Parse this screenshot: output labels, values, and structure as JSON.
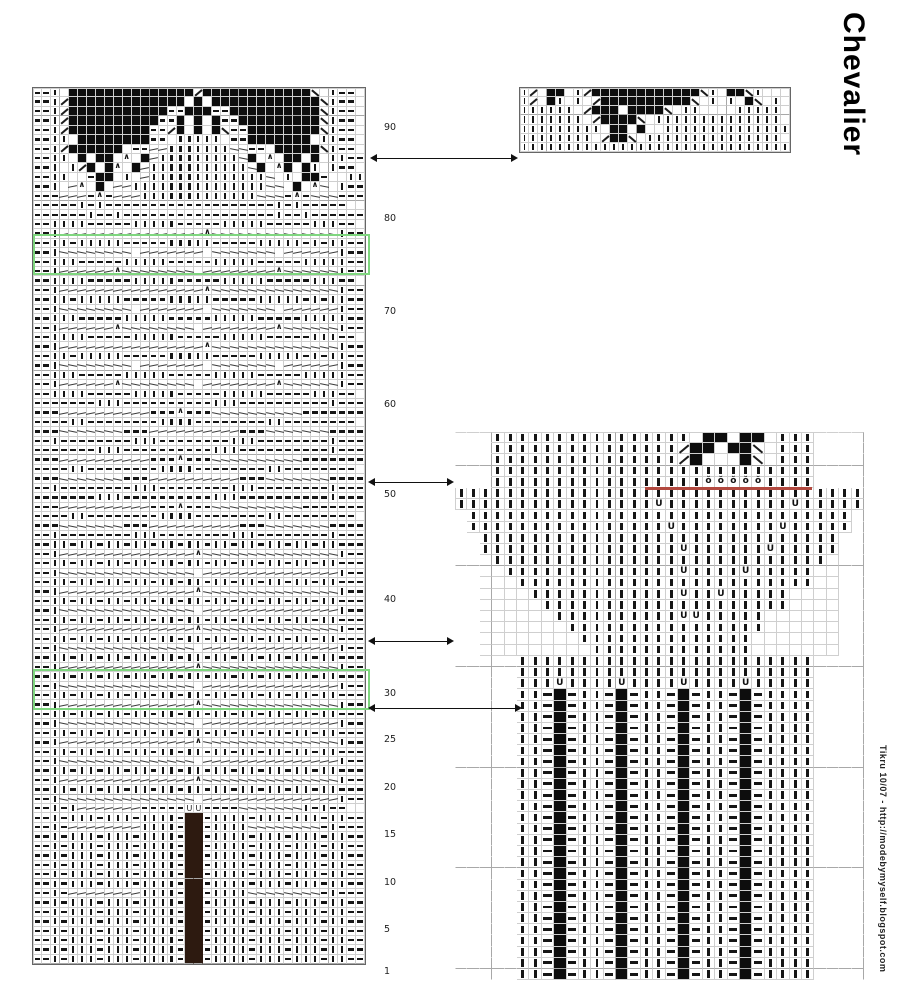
{
  "title": "Chevalier",
  "credit": "Tikru 10/07 - http://modebymyself.blogspot.com",
  "colors": {
    "background": "#ffffff",
    "symbol": "#151515",
    "grid": "#cfcfcf",
    "grid_heavy": "#a8a8a8",
    "repeat_box_green": "#7fd67f",
    "marker_line_red": "#b2493f",
    "dark_column_brown": "#2d1a10",
    "filled_square_black": "#0d0d0d"
  },
  "symbols": {
    "-": "purl-dash",
    "|": "knit-bar",
    "#": "filled-square",
    "B": "dark-column-stitch",
    "/": "right-leaning-decrease",
    "\\": "left-leaning-decrease",
    "^": "centered-double-decrease",
    "u": "u-stitch",
    "U": "bold-u-stitch",
    "o": "twisted-stitch",
    "z": "travel-line-up",
    "x": "travel-line-down",
    ".": "empty-cell",
    " ": "no-cell"
  },
  "row_numbers": {
    "x": 384,
    "labels": [
      {
        "n": "90",
        "y": 128
      },
      {
        "n": "80",
        "y": 219
      },
      {
        "n": "70",
        "y": 312
      },
      {
        "n": "60",
        "y": 405
      },
      {
        "n": "50",
        "y": 495
      },
      {
        "n": "40",
        "y": 600
      },
      {
        "n": "30",
        "y": 694
      },
      {
        "n": "25",
        "y": 740
      },
      {
        "n": "20",
        "y": 788
      },
      {
        "n": "15",
        "y": 835
      },
      {
        "n": "10",
        "y": 883
      },
      {
        "n": "5",
        "y": 930
      },
      {
        "n": "1",
        "y": 972
      }
    ]
  },
  "overlays": {
    "green_boxes": [
      {
        "x": 33,
        "y": 234,
        "w": 333,
        "h": 37
      },
      {
        "x": 33,
        "y": 669,
        "w": 333,
        "h": 37
      }
    ],
    "red_line": {
      "x": 645,
      "y": 487,
      "w": 167
    },
    "arrows": [
      {
        "x1": 372,
        "y": 158,
        "x2": 516
      },
      {
        "x1": 370,
        "y": 482,
        "x2": 452
      },
      {
        "x1": 370,
        "y": 641,
        "x2": 452
      },
      {
        "x1": 370,
        "y": 708,
        "x2": 520
      }
    ]
  },
  "charts": {
    "main": {
      "x": 33,
      "y": 88,
      "cols": 37,
      "cell_w": 8.97,
      "cell_h": 9.43,
      "pad": ".",
      "bordered": true,
      "rows": [
        "--|.##############/############\\.|--",
        "--|/#############.#.############\\|--",
        "--|/###########--###--##########\\|--",
        "--|/##########--#.#.#--#########\\|--",
        "--|/#########--/#.#.#\\--########\\|--",
        "--||.########--.|||||.--#######.||--",
        "--|/######.--zz|||||||xx--.#####\\|--",
        "--||.#.##.^.#z|||||||||x#.^.##.#.||--",
        "--|.|/#.#^.#z|||||||||||x#.^#.#|.|--",
        "--||..-##.|.z|||||||||||||x.|.##-..||",
        "--|.z^.#.zz|||||||||||||||xx.#.^x.|--",
        "---zzz-^-zzz|||||||||||||xxx-^-xxx---",
        "-----|-|-------------------|-|-----..",
        "------|--|-----------------|--|------",
        "--||||-----|||||-----|||||-----|||--",
        "--|zzzzzzzzzzzzzzzz^xxxxxxxxxxxxxx|--",
        "--||-|||||-----|||||-----|||||-|-||--",
        "--|xxxxxxxx.zzzzzzz.xxxxxxx.zzzzzz|--",
        "--|||-----|||||-----|||||-----|||||--",
        "--|zzzzzz^xxxxxxxx.zzzzzzzz^xxxxxx|--",
        "--||||-----|||||-----|||||-----|||--",
        "--|zzzzzzzzzzzzzzzz^xxxxxxxxxxxxxx|--",
        "--||-|||||-----|||||-----|||||-|-||--",
        "--|xxxxxxxx.zzzzzzz.xxxxxxx.zzzzzz|--",
        "--|||-----|||||-----|||||-----|||||--",
        "--|zzzzzz^xxxxxxxx.zzzzzzzz^xxxxxx|--",
        "--||||-----|||||-----|||||-----|||--",
        "--|zzzzzzzzzzzzzzzz^xxxxxxxxxxxxxx|--",
        "--||-|||||-----|||||-----|||||-|-||--",
        "--|xxxxxxxx.zzzzzzz.xxxxxxx.zzzzzz|--",
        "--|||-----|||||-----|||||-----|||||--",
        "--|zzzzzz^xxxxxxxx.zzzzzzzz^xxxxxx|--",
        "--||||-----|||||-----|||||-----|||--",
        "-------|||----------|||----------|---",
        "---zzzzzzzzzz---^---xxxxxxxxxx-------",
        "----||--------||||--------||--------",
        "---xxxxxxx---zzzzzzzzzz---xxxxxxx----",
        "--|--------|||--------|||--------|---",
        "-------|||----------|||----------|---",
        "---zzzzzzzzzz---^---xxxxxxxxxx-------",
        "----||--------||||--------||--------",
        "---xxxxxxx---zzzzzzzzzz---xxxxxxx----",
        "--|--------|||--------|||--------|---",
        "-------|||----------|||----------|---",
        "---zzzzzzzzzz---^---xxxxxxxxxx-------",
        "----||--------||||--------||--------",
        "---xxxxxxx---zzzzzzzzzz---xxxxxxx----",
        "--|--------|||--------|||--------|---",
        "--||-||-||-||-||-||-||-||-||-||-||---",
        "--|zzzzzzzzzzzzzzz^xxxxxxxxxxxxxxx|--",
        "--||-||-||-||-||-||-||-||-||-||-||---",
        "--|xxxxxxxxxxxxxxx.zzzzzzzzzzzzzzz|--",
        "--||-||-||-||-||-||-||-||-||-||-||---",
        "--|zzzzzzzzzzzzzzz^xxxxxxxxxxxxxxx|--",
        "--||-||-||-||-||-||-||-||-||-||-||---",
        "--|xxxxxxxxxxxxxxx.zzzzzzzzzzzzzzz|--",
        "--||-||-||-||-||-||-||-||-||-||-||---",
        "--|zzzzzzzzzzzzzzz^xxxxxxxxxxxxxxx|--",
        "--||-||-||-||-||-||-||-||-||-||-||---",
        "--|xxxxxxxxxxxxxxx.zzzzzzzzzzzzzzz|--",
        "--||-||-||-||-||-||-||-||-||-||-||---",
        "--|zzzzzzzzzzzzzzz^xxxxxxxxxxxxxxx|--",
        "--||-||-||-||-||-||-||-||-||-||-||---",
        "--|xxxxxxxxxxxxxxx.zzzzzzzzzzzzzzz|--",
        "--||-||-||-||-||-||-||-||-||-||-||---",
        "--|zzzzzzzzzzzzzzz^xxxxxxxxxxxxxxx|--",
        "--||-||-||-||-||-||-||-||-||-||-||---",
        "--|xxxxxxxxxxxxxxx.zzzzzzzzzzzzzzz|--",
        "--||-||-||-||-||-||-||-||-||-||-||---",
        "--|zzzzzzzzzzzzzzz^xxxxxxxxxxxxxxx|--",
        "--||-||-||-||-||-||-||-||-||-||-||---",
        "--|xxxxxxxxxxxxxxx.zzzzzzzzzzzzzzz|--",
        "--||-||-||-||-||-||-||-||-||-||-||---",
        "--|zzzzzzzzzzzzzzz^xxxxxxxxxxxxxxx|--",
        "--||-||-||-||-||-||-||-||-||-||-||---",
        "--|xxxxxxxxxxxxxxx.zzzzzzzzzzzzzzz|--",
        "--|-|zzzzzzz-----uu----xxxxxxx|-|--..",
        "--|-|||-|||-||||-BB-||||-|||-|||-||--",
        "--|-zzzzzzzz||||-BB-||||xxxxxxxx-|---",
        "--|-|||-|||-||||-BB-||||-|||-|||-||--",
        "--|-|||-|||-||||-BB-||||-|||-|||-||--",
        "--|-|||-|||-||||-BB-||||-|||-|||-||--",
        "--|-|||-|||-||||-BB-||||-|||-|||-||--",
        "--|-|||-|||-||||-BB-||||-|||-|||-||--",
        "--|-|||-|||-||||-BB-||||-|||-|||-||--",
        "--|-zzzzzzzz||||-BB-||||xxxxxxxx-|---",
        "--|-|||-|||-||||-BB-||||-|||-|||-||--",
        "--|-|||-|||-||||-BB-||||-|||-|||-||--",
        "--|-|||-|||-||||-BB-||||-|||-|||-||--",
        "--|-|||-|||-||||-BB-||||-|||-|||-||--",
        "--|-|||-|||-||||-BB-||||-|||-|||-||--",
        "--|-|||-|||-||||-BB-||||-|||-|||-||--",
        "--|-|||-|||-||||-BB-||||-|||-|||-||--"
      ]
    },
    "top_right": {
      "x": 520,
      "y": 88,
      "cols": 30,
      "cell_w": 9.0,
      "cell_h": 9.15,
      "pad": ".",
      "bordered": true,
      "rows": [
        "|/.##.|/############\\|.##\\|..",
        "|/.#|.|./##########\\.|.|.#\\.|.",
        "||||||./###.####\\.||....|||||.",
        "|||||||./####\\.||||||||||||||.",
        "|||||||||.##.#..||||||||||||||",
        "||||||||./##\\.|||||||||||||||.",
        "||||||||||||||||||||||||||||||"
      ]
    },
    "right": {
      "x": 455,
      "y": 432,
      "cols": 33,
      "cell_w": 12.4,
      "cell_h": 11.2,
      "pad": " ",
      "bordered": false,
      "rows": [
        "   ||||||||||||||||.##.##.|||    ",
        "   |||||||||||||||/##.##\\.|||    ",
        "   |||||||||||||||/#...#\\.|||    ",
        "   ||||||||||||||||||||||||||    ",
        "   |||||||||||||||||ooooo||||    ",
        "|||||||||||||||||||||||||||||||||",
        "||||||||||||||||U||||||||||U|||||",
        " ||||||||||||||||||||||||||||||| ",
        " ||||||||||||||||U||||||||U||||| ",
        "  |||||||||||||||||||||||||||||  ",
        "  ||||||||||||||||U||||||U|||||  ",
        "  .|||||||||||||||||||||||||||.  ",
        "  ..||||||||||||||U||||U|||||..  ",
        "  ...||||||||||||||||||||||||..  ",
        "  ....||||||||||||U||U|||||....  ",
        "  .....||||||||||||||||||||....  ",
        "  ......||||||||||UU|||||......  ",
        "  .......||||||||||||||||......  ",
        "  ........||||||||||||||.......  ",
        "  .........|||||||||||||.......  ",
        "     ||||||||||||||||||||||||    ",
        "     ||||||||||||||||||||||||    ",
        "     |||U||||U||||U||||U|||||    ",
        "     ||-#-||-#-||-#-||-#-||||    ",
        "     ||-#-||-#-||-#-||-#-||||    ",
        "     ||-#-||-#-||-#-||-#-||||    ",
        "     ||-#-||-#-||-#-||-#-||||    ",
        "     ||-#-||-#-||-#-||-#-||||    ",
        "     ||-#-||-#-||-#-||-#-||||    ",
        "     ||-#-||-#-||-#-||-#-||||    ",
        "     ||-#-||-#-||-#-||-#-||||    ",
        "     ||-#-||-#-||-#-||-#-||||    ",
        "     ||-#-||-#-||-#-||-#-||||    ",
        "     ||-#-||-#-||-#-||-#-||||    ",
        "     ||-#-||-#-||-#-||-#-||||    ",
        "     ||-#-||-#-||-#-||-#-||||    ",
        "     ||-#-||-#-||-#-||-#-||||    ",
        "     ||-#-||-#-||-#-||-#-||||    ",
        "     ||-#-||-#-||-#-||-#-||||    ",
        "     ||-#-||-#-||-#-||-#-||||    ",
        "     ||-#-||-#-||-#-||-#-||||    ",
        "     ||-#-||-#-||-#-||-#-||||    ",
        "     ||-#-||-#-||-#-||-#-||||    ",
        "     ||-#-||-#-||-#-||-#-||||    ",
        "     ||-#-||-#-||-#-||-#-||||    ",
        "     ||-#-||-#-||-#-||-#-||||    ",
        "     ||-#-||-#-||-#-||-#-||||    ",
        "     ||-#-||-#-||-#-||-#-||||    ",
        "     ||-#-||-#-||-#-||-#-||||    "
      ]
    }
  }
}
